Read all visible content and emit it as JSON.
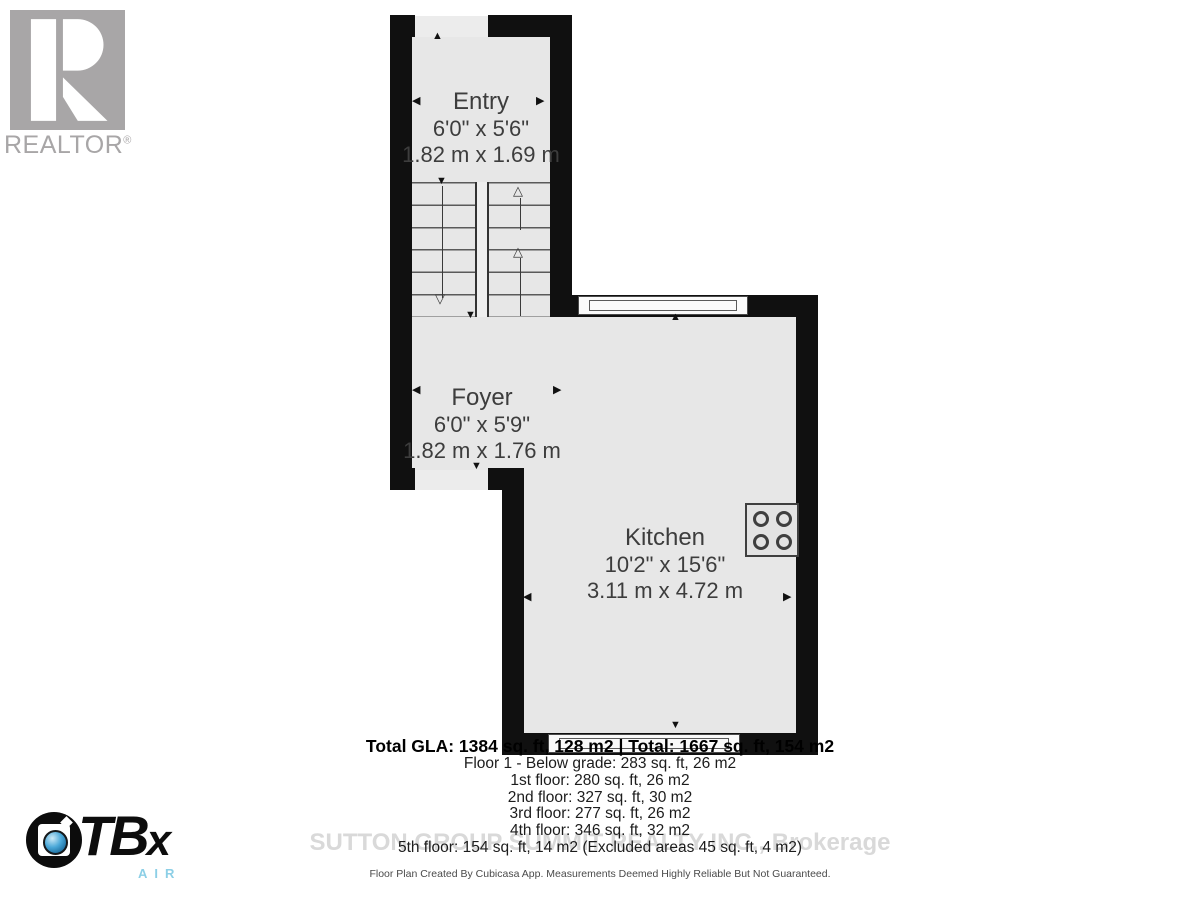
{
  "branding": {
    "realtor_wordmark": "REALTOR",
    "realtor_reg_mark": "®",
    "ctbx_letters_main": "TB",
    "ctbx_letters_x": "x",
    "ctbx_air": "AIR"
  },
  "watermark": "SUTTON GROUP SUMMIT REALTY INC., Brokerage",
  "rooms": [
    {
      "name": "Entry",
      "imperial": "6'0\" x 5'6\"",
      "metric": "1.82 m x 1.69 m"
    },
    {
      "name": "Foyer",
      "imperial": "6'0\" x 5'9\"",
      "metric": "1.82 m x 1.76 m"
    },
    {
      "name": "Kitchen",
      "imperial": "10'2\" x 15'6\"",
      "metric": "3.11 m x 4.72 m"
    }
  ],
  "summary": {
    "total_line": "Total GLA: 1384 sq. ft, 128 m2 | Total: 1667 sq. ft, 154 m2",
    "floors": [
      "Floor 1 - Below grade: 283 sq. ft, 26 m2",
      "1st floor: 280 sq. ft, 26 m2",
      "2nd floor: 327 sq. ft, 30 m2",
      "3rd floor: 277 sq. ft, 26 m2",
      "4th floor: 346 sq. ft, 32 m2",
      "5th floor: 154 sq. ft, 14 m2 (Excluded areas 45 sq. ft, 4 m2)"
    ]
  },
  "footer": "Floor Plan Created By Cubicasa App. Measurements Deemed Highly Reliable But Not Guaranteed.",
  "glyphs": {
    "up": "▲",
    "down": "▼",
    "left": "◀",
    "right": "▶",
    "up_open": "△",
    "down_open": "▽"
  },
  "colors": {
    "floor_fill": "#e7e7e7",
    "wall": "#101010",
    "realtor_gray": "#a8a6a7",
    "watermark_gray": "#d9d9d9",
    "ctbx_lens_blue": "#2e8fc4",
    "ctbx_air_blue": "#8ccfe6",
    "label_text": "#3d3d3d"
  }
}
